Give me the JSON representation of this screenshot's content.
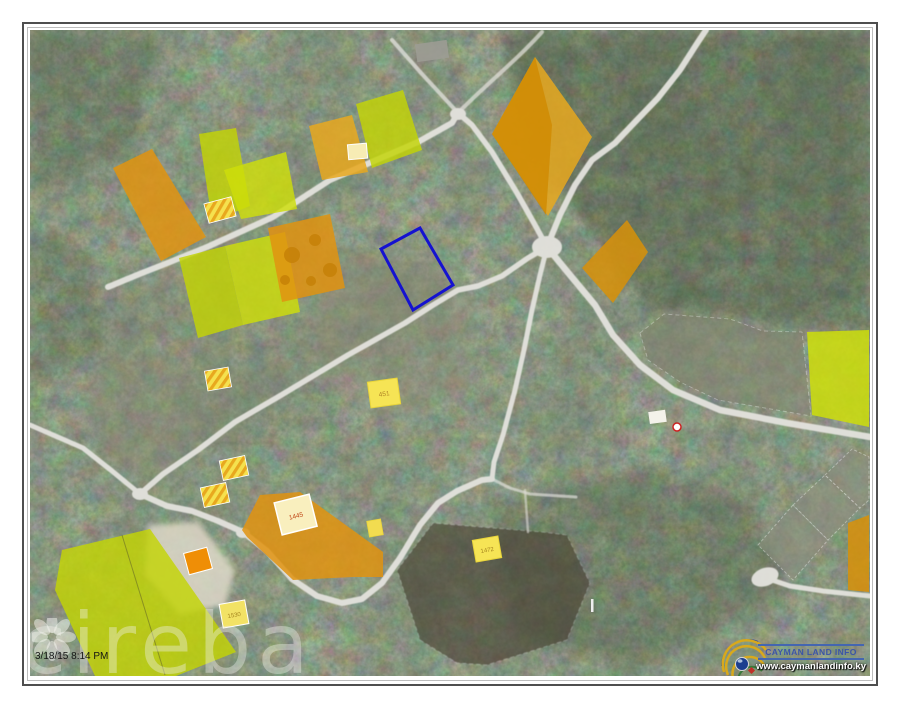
{
  "map": {
    "timestamp": "3/18/15 8:14 PM",
    "watermark": "cireba",
    "branding": {
      "name": "CAYMAN LAND INFO",
      "website": "www.caymanlandinfo.ky"
    },
    "parcel_labels": {
      "building_1445": "1445",
      "lot_1530": "1530",
      "lot_1472": "1472",
      "lot_451": "451"
    },
    "colors": {
      "subject_outline": "#1512d0",
      "parcel_yellow": "#c3d405",
      "parcel_yellow_bright": "#cede0a",
      "parcel_orange": "#e09310",
      "road": "#e4e3de"
    }
  }
}
